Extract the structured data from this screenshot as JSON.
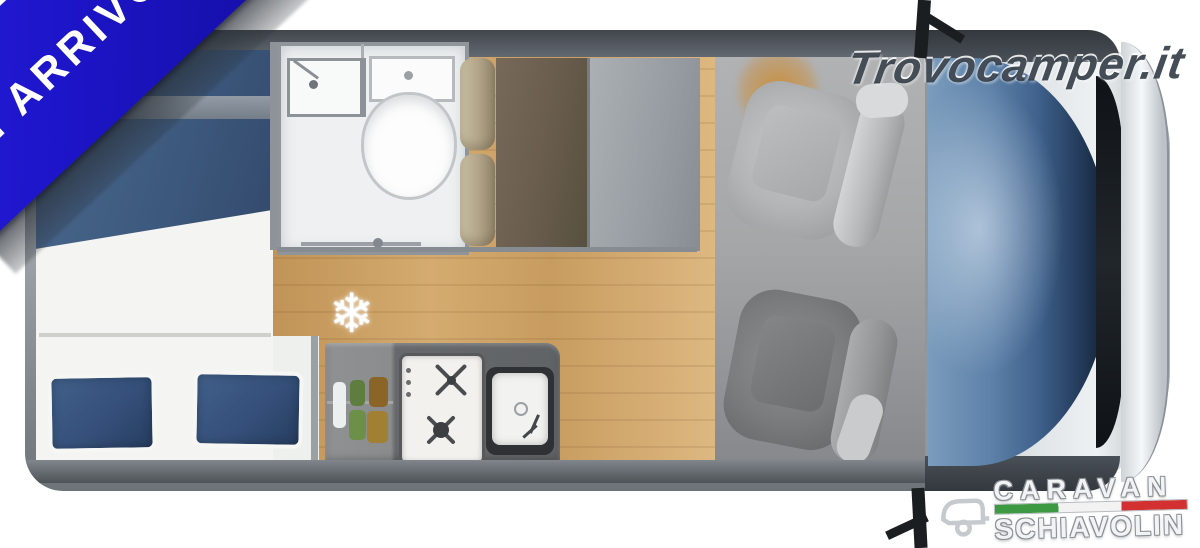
{
  "page": {
    "background": "#ffffff",
    "description": "top-down campervan floorplan listing photo"
  },
  "ribbon": {
    "label": "IN ARRIVO",
    "bg_color": "#1d15c9",
    "text_color": "#ffffff"
  },
  "watermark": {
    "text": "Trovocamper.it",
    "color": "#2b3440"
  },
  "dealer_logo": {
    "line1": "CARAVAN",
    "line2": "SCHIAVOLIN",
    "flag_colors": [
      "#3d9a43",
      "#f2f2f2",
      "#d33131"
    ],
    "icon": "caravan-trailer-icon"
  },
  "floorplan": {
    "view": "top-down camper van",
    "symbols": {
      "fridge_snowflake": "❄"
    },
    "areas": [
      "rear-transverse-bed",
      "bathroom-with-sink-and-toilet",
      "dinette-bench",
      "wardrobe-panel",
      "kitchen-hob-and-sink",
      "wood-floor",
      "cab-with-two-swivel-seats",
      "windshield-and-hood"
    ],
    "colors": {
      "duvet_blue": "#3d5a7e",
      "pillow_blue": "#35507a",
      "wood_floor": "#d4ab70",
      "kitchen_counter": "#66696b",
      "cab_floor": "#a6a7a8",
      "windshield_blue": "#3f618c",
      "van_wall_gray": "#8b9196",
      "bench_tan": "#b1a387",
      "bench_dark": "#685c4d"
    }
  }
}
